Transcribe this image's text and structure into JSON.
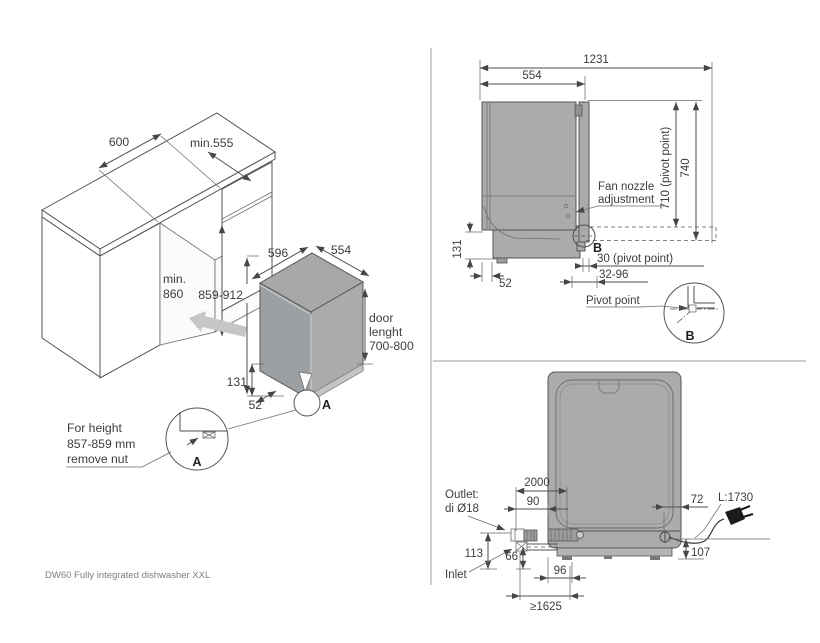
{
  "page": {
    "footer_text": "DW60 Fully integrated dishwasher XXL"
  },
  "colors": {
    "line": "#4f4f4f",
    "text": "#3d3d3d",
    "body_gray": "#a9abad",
    "plinth_gray": "#c2c4c6",
    "arrow_gray": "#c4c6c8",
    "divider": "#9b9b9b"
  },
  "isometric_view": {
    "niche_width": "600",
    "niche_depth": "min.555",
    "niche_height_line1": "min.",
    "niche_height_line2": "860",
    "dw_width": "596",
    "dw_depth": "554",
    "dw_height": "859-912",
    "door_line1": "door",
    "door_line2": "lenght",
    "door_line3": "700-800",
    "plinth_height": "131",
    "plinth_depth": "52",
    "detail_marker": "A",
    "note_line1": "For height",
    "note_line2": "857-859 mm",
    "note_line3": "remove nut",
    "note_detail_marker": "A"
  },
  "side_view": {
    "depth_door_open": "1231",
    "body_depth": "554",
    "height_total": "740",
    "height_pivot": "710 (pivot point)",
    "fan_line1": "Fan nozzle",
    "fan_line2": "adjustment",
    "marker": "B",
    "pivot_offset": "30 (pivot point)",
    "pivot_range": "32-96",
    "plinth_height": "131",
    "plinth_depth": "52",
    "pivot_label": "Pivot point",
    "detail_marker": "B"
  },
  "rear_view": {
    "drain_hose_length": "2000",
    "drain_offset": "90",
    "cord_offset": "72",
    "cord_length": "L:1730",
    "outlet_line1": "Outlet:",
    "outlet_line2": "di Ø18",
    "outlet_height": "113",
    "inlet_height": "66",
    "drain_position": "96",
    "inlet_label": "Inlet",
    "cord_height": "107",
    "hose_reach": "≥1625"
  }
}
